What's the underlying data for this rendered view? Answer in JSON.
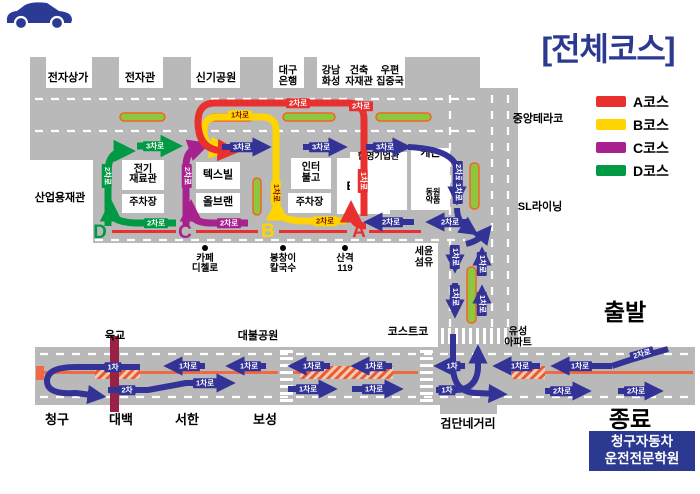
{
  "title": "[전체코스]",
  "start_label": "출발",
  "end_label": "종료",
  "school": {
    "line1": "청구자동차",
    "line2": "운전전문학원"
  },
  "legend": {
    "items": [
      {
        "label": "A코스",
        "color": "#e8312e"
      },
      {
        "label": "B코스",
        "color": "#ffd400"
      },
      {
        "label": "C코스",
        "color": "#a7218f"
      },
      {
        "label": "D코스",
        "color": "#009a44"
      }
    ]
  },
  "map": {
    "colors": {
      "road": "#b9b9b9",
      "navy": "#333397",
      "red": "#e8312e",
      "yellow": "#ffd400",
      "magenta": "#a7218f",
      "green": "#009a44",
      "orange": "#ee6a45",
      "maroon": "#982145",
      "medianFill": "#8dc63f",
      "medianStroke": "#f26522",
      "title": "#2b3990",
      "chipYellowText": "#7b1500",
      "hatchBg": "#f5c9b5",
      "hatchLine": "#e85c2e"
    },
    "roads": [
      [
        30,
        88,
        450,
        72
      ],
      [
        93,
        160,
        387,
        83
      ],
      [
        438,
        88,
        80,
        259
      ],
      [
        35,
        347,
        660,
        58
      ],
      [
        440,
        405,
        57,
        9
      ]
    ],
    "top_blocks": [
      [
        30,
        57,
        16,
        31
      ],
      [
        92,
        57,
        27,
        31
      ],
      [
        163,
        57,
        28,
        31
      ],
      [
        240,
        57,
        33,
        31
      ],
      [
        304,
        57,
        13,
        31
      ],
      [
        405,
        57,
        75,
        31
      ]
    ],
    "dashes": [
      [
        35,
        99,
        478,
        99
      ],
      [
        35,
        131,
        478,
        131
      ],
      [
        95,
        240,
        465,
        240
      ],
      [
        40,
        354,
        692,
        354
      ],
      [
        40,
        397,
        692,
        397
      ],
      [
        450,
        95,
        450,
        327
      ],
      [
        492,
        95,
        492,
        327
      ],
      [
        508,
        95,
        508,
        327
      ]
    ],
    "medians": [
      [
        120,
        113,
        45,
        8
      ],
      [
        210,
        114,
        43,
        7
      ],
      [
        283,
        113,
        52,
        8
      ],
      [
        376,
        113,
        55,
        8
      ],
      [
        470,
        163,
        9,
        46
      ],
      [
        253,
        178,
        8,
        37
      ],
      [
        467,
        267,
        9,
        56
      ]
    ],
    "red_lines": [
      [
        112,
        230,
        64,
        3
      ],
      [
        196,
        230,
        62,
        3
      ],
      [
        279,
        230,
        68,
        3
      ],
      [
        369,
        230,
        52,
        3
      ]
    ],
    "orange_lines": [
      [
        44,
        371,
        234,
        3
      ],
      [
        293,
        371,
        125,
        3
      ],
      [
        512,
        371,
        181,
        3
      ]
    ],
    "hatches": [
      [
        95,
        366,
        45,
        13
      ],
      [
        300,
        366,
        93,
        13
      ],
      [
        512,
        366,
        33,
        13
      ]
    ],
    "orange_cap": [
      36,
      366,
      8,
      14
    ],
    "overpass": [
      110,
      336,
      9,
      76
    ],
    "crosswalks": [
      {
        "x": 280,
        "y": 348,
        "w": 13,
        "h": 57,
        "o": "h"
      },
      {
        "x": 420,
        "y": 348,
        "w": 13,
        "h": 57,
        "o": "h"
      },
      {
        "x": 440,
        "y": 328,
        "w": 72,
        "h": 16,
        "o": "v"
      }
    ],
    "arrows": [
      {
        "d": "M137,146 L174,146",
        "c": "green",
        "w": 7
      },
      {
        "d": "M108,226 L108,172 Q108,152 124,151 L127,151",
        "c": "green",
        "w": 7
      },
      {
        "d": "M176,223 L140,223 Q112,223 111,212 L111,208",
        "c": "green",
        "w": 7
      },
      {
        "d": "M186,226 L186,166 Q186,150 199,147 L202,146",
        "c": "magenta",
        "w": 7
      },
      {
        "d": "M248,223 L212,223 Q192,223 191,212 L191,208",
        "c": "magenta",
        "w": 7
      },
      {
        "d": "M276,216 L276,131 Q276,117 262,117 L217,117 Q204,117 204,131 Q204,146 218,149 L223,150",
        "c": "yellow",
        "w": 7
      },
      {
        "d": "M346,221 L308,221 Q278,221 277,210 L277,207",
        "c": "yellow",
        "w": 7
      },
      {
        "d": "M364,216 L364,119 Q364,103 348,103 L215,103 Q198,103 198,122 Q198,146 216,150 L231,151",
        "c": "red",
        "w": 7
      },
      {
        "d": "M366,226 Q352,226 351,212 L351,209",
        "c": "red",
        "w": 7
      },
      {
        "d": "M222,147 L264,147",
        "c": "navy",
        "w": 6
      },
      {
        "d": "M303,147 L340,147",
        "c": "navy",
        "w": 6
      },
      {
        "d": "M366,147 L404,147",
        "c": "navy",
        "w": 6
      },
      {
        "d": "M408,147 Q452,149 457,168 L457,198",
        "c": "navy",
        "w": 6
      },
      {
        "d": "M457,208 Q457,223 469,229 L472,231",
        "c": "navy",
        "w": 6
      },
      {
        "d": "M466,244 Q479,241 487,231",
        "c": "navy",
        "w": 6
      },
      {
        "d": "M455,247 L455,266",
        "c": "navy",
        "w": 6
      },
      {
        "d": "M455,283 L455,311",
        "c": "navy",
        "w": 6
      },
      {
        "d": "M482,276 L482,254",
        "c": "navy",
        "w": 6
      },
      {
        "d": "M482,316 L482,292",
        "c": "navy",
        "w": 6
      },
      {
        "d": "M414,222 L371,222",
        "c": "navy",
        "w": 6
      },
      {
        "d": "M468,222 L433,222",
        "c": "navy",
        "w": 6
      },
      {
        "d": "M140,367 L76,367 Q47,367 47,381 Q47,395 76,393 L99,396",
        "c": "navy",
        "w": 6
      },
      {
        "d": "M205,366 L171,366",
        "c": "navy",
        "w": 6
      },
      {
        "d": "M266,366 L233,366",
        "c": "navy",
        "w": 6
      },
      {
        "d": "M330,366 L295,366",
        "c": "navy",
        "w": 6
      },
      {
        "d": "M392,366 L358,366",
        "c": "navy",
        "w": 6
      },
      {
        "d": "M465,366 L441,366",
        "c": "navy",
        "w": 6
      },
      {
        "d": "M108,390 L148,390 L186,383 L228,383",
        "c": "navy",
        "w": 6
      },
      {
        "d": "M288,389 L330,389",
        "c": "navy",
        "w": 6
      },
      {
        "d": "M352,389 L396,389",
        "c": "navy",
        "w": 6
      },
      {
        "d": "M436,390 L458,390",
        "c": "navy",
        "w": 6,
        "head": false
      },
      {
        "d": "M453,334 L453,366 Q453,392 476,393 L500,394",
        "c": "navy",
        "w": 6
      },
      {
        "d": "M458,390 Q477,388 478,368 L478,352",
        "c": "navy",
        "w": 6
      },
      {
        "d": "M668,349 L630,360 L612,366",
        "c": "navy",
        "w": 6,
        "head": false
      },
      {
        "d": "M612,366 L558,366",
        "c": "navy",
        "w": 6
      },
      {
        "d": "M540,366 L500,366",
        "c": "navy",
        "w": 6
      },
      {
        "d": "M545,391 L584,391",
        "c": "navy",
        "w": 6
      },
      {
        "d": "M618,391 L656,391",
        "c": "navy",
        "w": 6
      }
    ],
    "chips": [
      {
        "t": "3차로",
        "x": 155,
        "y": 146,
        "bg": "green"
      },
      {
        "t": "3차로",
        "x": 242,
        "y": 147,
        "bg": "navy"
      },
      {
        "t": "3차로",
        "x": 321,
        "y": 147,
        "bg": "navy"
      },
      {
        "t": "3차로",
        "x": 385,
        "y": 147,
        "bg": "navy"
      },
      {
        "t": "1차로",
        "x": 240,
        "y": 115,
        "bg": "yellow"
      },
      {
        "t": "2차로",
        "x": 298,
        "y": 103,
        "bg": "red"
      },
      {
        "t": "2차로",
        "x": 361,
        "y": 106,
        "bg": "red"
      },
      {
        "t": "2차로",
        "x": 107,
        "y": 176,
        "bg": "green",
        "rot": 90
      },
      {
        "t": "2차로",
        "x": 187,
        "y": 176,
        "bg": "magenta",
        "rot": 90
      },
      {
        "t": "1차로",
        "x": 276,
        "y": 193,
        "bg": "yellow",
        "rot": 90
      },
      {
        "t": "1차로",
        "x": 363,
        "y": 181,
        "bg": "red",
        "rot": 90
      },
      {
        "t": "2차로",
        "x": 156,
        "y": 223,
        "bg": "green"
      },
      {
        "t": "2차로",
        "x": 229,
        "y": 223,
        "bg": "magenta"
      },
      {
        "t": "2차로",
        "x": 325,
        "y": 221,
        "bg": "yellow"
      },
      {
        "t": "2차로",
        "x": 391,
        "y": 222,
        "bg": "navy"
      },
      {
        "t": "2차로",
        "x": 450,
        "y": 222,
        "bg": "navy"
      },
      {
        "t": "2차로",
        "x": 458,
        "y": 173,
        "bg": "navy",
        "rot": 90
      },
      {
        "t": "1차로",
        "x": 458,
        "y": 192,
        "bg": "navy",
        "rot": 90
      },
      {
        "t": "1차로",
        "x": 455,
        "y": 257,
        "bg": "navy",
        "rot": 90
      },
      {
        "t": "1차로",
        "x": 482,
        "y": 264,
        "bg": "navy",
        "rot": 90
      },
      {
        "t": "1차로",
        "x": 455,
        "y": 297,
        "bg": "navy",
        "rot": 90
      },
      {
        "t": "1차로",
        "x": 482,
        "y": 304,
        "bg": "navy",
        "rot": 90
      },
      {
        "t": "1차",
        "x": 113,
        "y": 367,
        "bg": "navy"
      },
      {
        "t": "1차로",
        "x": 188,
        "y": 366,
        "bg": "navy"
      },
      {
        "t": "1차로",
        "x": 249,
        "y": 366,
        "bg": "navy"
      },
      {
        "t": "1차로",
        "x": 312,
        "y": 366,
        "bg": "navy"
      },
      {
        "t": "1차로",
        "x": 374,
        "y": 366,
        "bg": "navy"
      },
      {
        "t": "1차",
        "x": 452,
        "y": 366,
        "bg": "navy"
      },
      {
        "t": "1차로",
        "x": 520,
        "y": 366,
        "bg": "navy"
      },
      {
        "t": "1차로",
        "x": 580,
        "y": 366,
        "bg": "navy"
      },
      {
        "t": "2차로",
        "x": 642,
        "y": 354,
        "bg": "navy",
        "rot": -16
      },
      {
        "t": "2차",
        "x": 127,
        "y": 390,
        "bg": "navy"
      },
      {
        "t": "1차로",
        "x": 205,
        "y": 383,
        "bg": "navy"
      },
      {
        "t": "1차로",
        "x": 308,
        "y": 389,
        "bg": "navy"
      },
      {
        "t": "1차로",
        "x": 374,
        "y": 389,
        "bg": "navy"
      },
      {
        "t": "1차",
        "x": 447,
        "y": 390,
        "bg": "navy"
      },
      {
        "t": "2차로",
        "x": 562,
        "y": 391,
        "bg": "navy"
      },
      {
        "t": "2차로",
        "x": 636,
        "y": 391,
        "bg": "navy"
      }
    ],
    "buildings": [
      {
        "t": "전기\n재료관",
        "x": 122,
        "y": 160,
        "w": 42,
        "h": 30,
        "s": 10
      },
      {
        "t": "주차장",
        "x": 122,
        "y": 194,
        "w": 42,
        "h": 19,
        "s": 10
      },
      {
        "t": "텍스빌",
        "x": 196,
        "y": 162,
        "w": 44,
        "h": 27,
        "s": 11
      },
      {
        "t": "올브랜",
        "x": 196,
        "y": 193,
        "w": 44,
        "h": 20,
        "s": 11
      },
      {
        "t": "인터\n불고",
        "x": 291,
        "y": 158,
        "w": 40,
        "h": 31,
        "s": 10
      },
      {
        "t": "주차장",
        "x": 288,
        "y": 193,
        "w": 43,
        "h": 20,
        "s": 10
      },
      {
        "t": "EXCO",
        "x": 337,
        "y": 158,
        "w": 53,
        "h": 56,
        "s": 12
      },
      {
        "t": "한영기업관",
        "x": 350,
        "y": 152,
        "w": 57,
        "h": 58,
        "s": 9,
        "v": "top"
      },
      {
        "t": "케논",
        "x": 411,
        "y": 148,
        "w": 39,
        "h": 62,
        "s": 11,
        "v": "top"
      }
    ],
    "labels": [
      {
        "t": "전자상가",
        "x": 68,
        "y": 79,
        "s": 11
      },
      {
        "t": "전자관",
        "x": 140,
        "y": 79,
        "s": 11
      },
      {
        "t": "신기공원",
        "x": 216,
        "y": 79,
        "s": 11
      },
      {
        "t": "대구\n은행",
        "x": 288,
        "y": 77,
        "s": 10
      },
      {
        "t": "강남\n화성",
        "x": 331,
        "y": 77,
        "s": 10
      },
      {
        "t": "건축\n자재관",
        "x": 359,
        "y": 77,
        "s": 10
      },
      {
        "t": "우편\n집중국",
        "x": 390,
        "y": 77,
        "s": 10
      },
      {
        "t": "산업용재관",
        "x": 60,
        "y": 199,
        "s": 11
      },
      {
        "t": "중앙테라코",
        "x": 538,
        "y": 120,
        "s": 11
      },
      {
        "t": "SL라이닝",
        "x": 540,
        "y": 208,
        "s": 11
      },
      {
        "t": "세윤\n섬유",
        "x": 424,
        "y": 258,
        "s": 10
      },
      {
        "t": "코스트코",
        "x": 408,
        "y": 333,
        "s": 11
      },
      {
        "t": "유성\n아파트",
        "x": 518,
        "y": 338,
        "s": 10
      },
      {
        "t": "육교",
        "x": 115,
        "y": 337,
        "s": 11
      },
      {
        "t": "대불공원",
        "x": 258,
        "y": 337,
        "s": 11
      },
      {
        "t": "검단네거리",
        "x": 468,
        "y": 424,
        "s": 12
      },
      {
        "t": "청구",
        "x": 57,
        "y": 420,
        "s": 13
      },
      {
        "t": "대백",
        "x": 121,
        "y": 420,
        "s": 13
      },
      {
        "t": "서한",
        "x": 187,
        "y": 420,
        "s": 13
      },
      {
        "t": "보성",
        "x": 265,
        "y": 420,
        "s": 13
      },
      {
        "t": "동원\n약품",
        "x": 433,
        "y": 197,
        "s": 8
      }
    ],
    "pois": [
      {
        "t": "카페\n디첼로",
        "x": 205,
        "y": 248
      },
      {
        "t": "봉창이\n칼국수",
        "x": 283,
        "y": 248
      },
      {
        "t": "산격\n119",
        "x": 345,
        "y": 248
      }
    ],
    "course_letters": [
      {
        "t": "D",
        "x": 100,
        "y": 233,
        "c": "green"
      },
      {
        "t": "C",
        "x": 185,
        "y": 233,
        "c": "magenta"
      },
      {
        "t": "B",
        "x": 268,
        "y": 232,
        "c": "yellow"
      },
      {
        "t": "A",
        "x": 359,
        "y": 232,
        "c": "red"
      }
    ]
  }
}
